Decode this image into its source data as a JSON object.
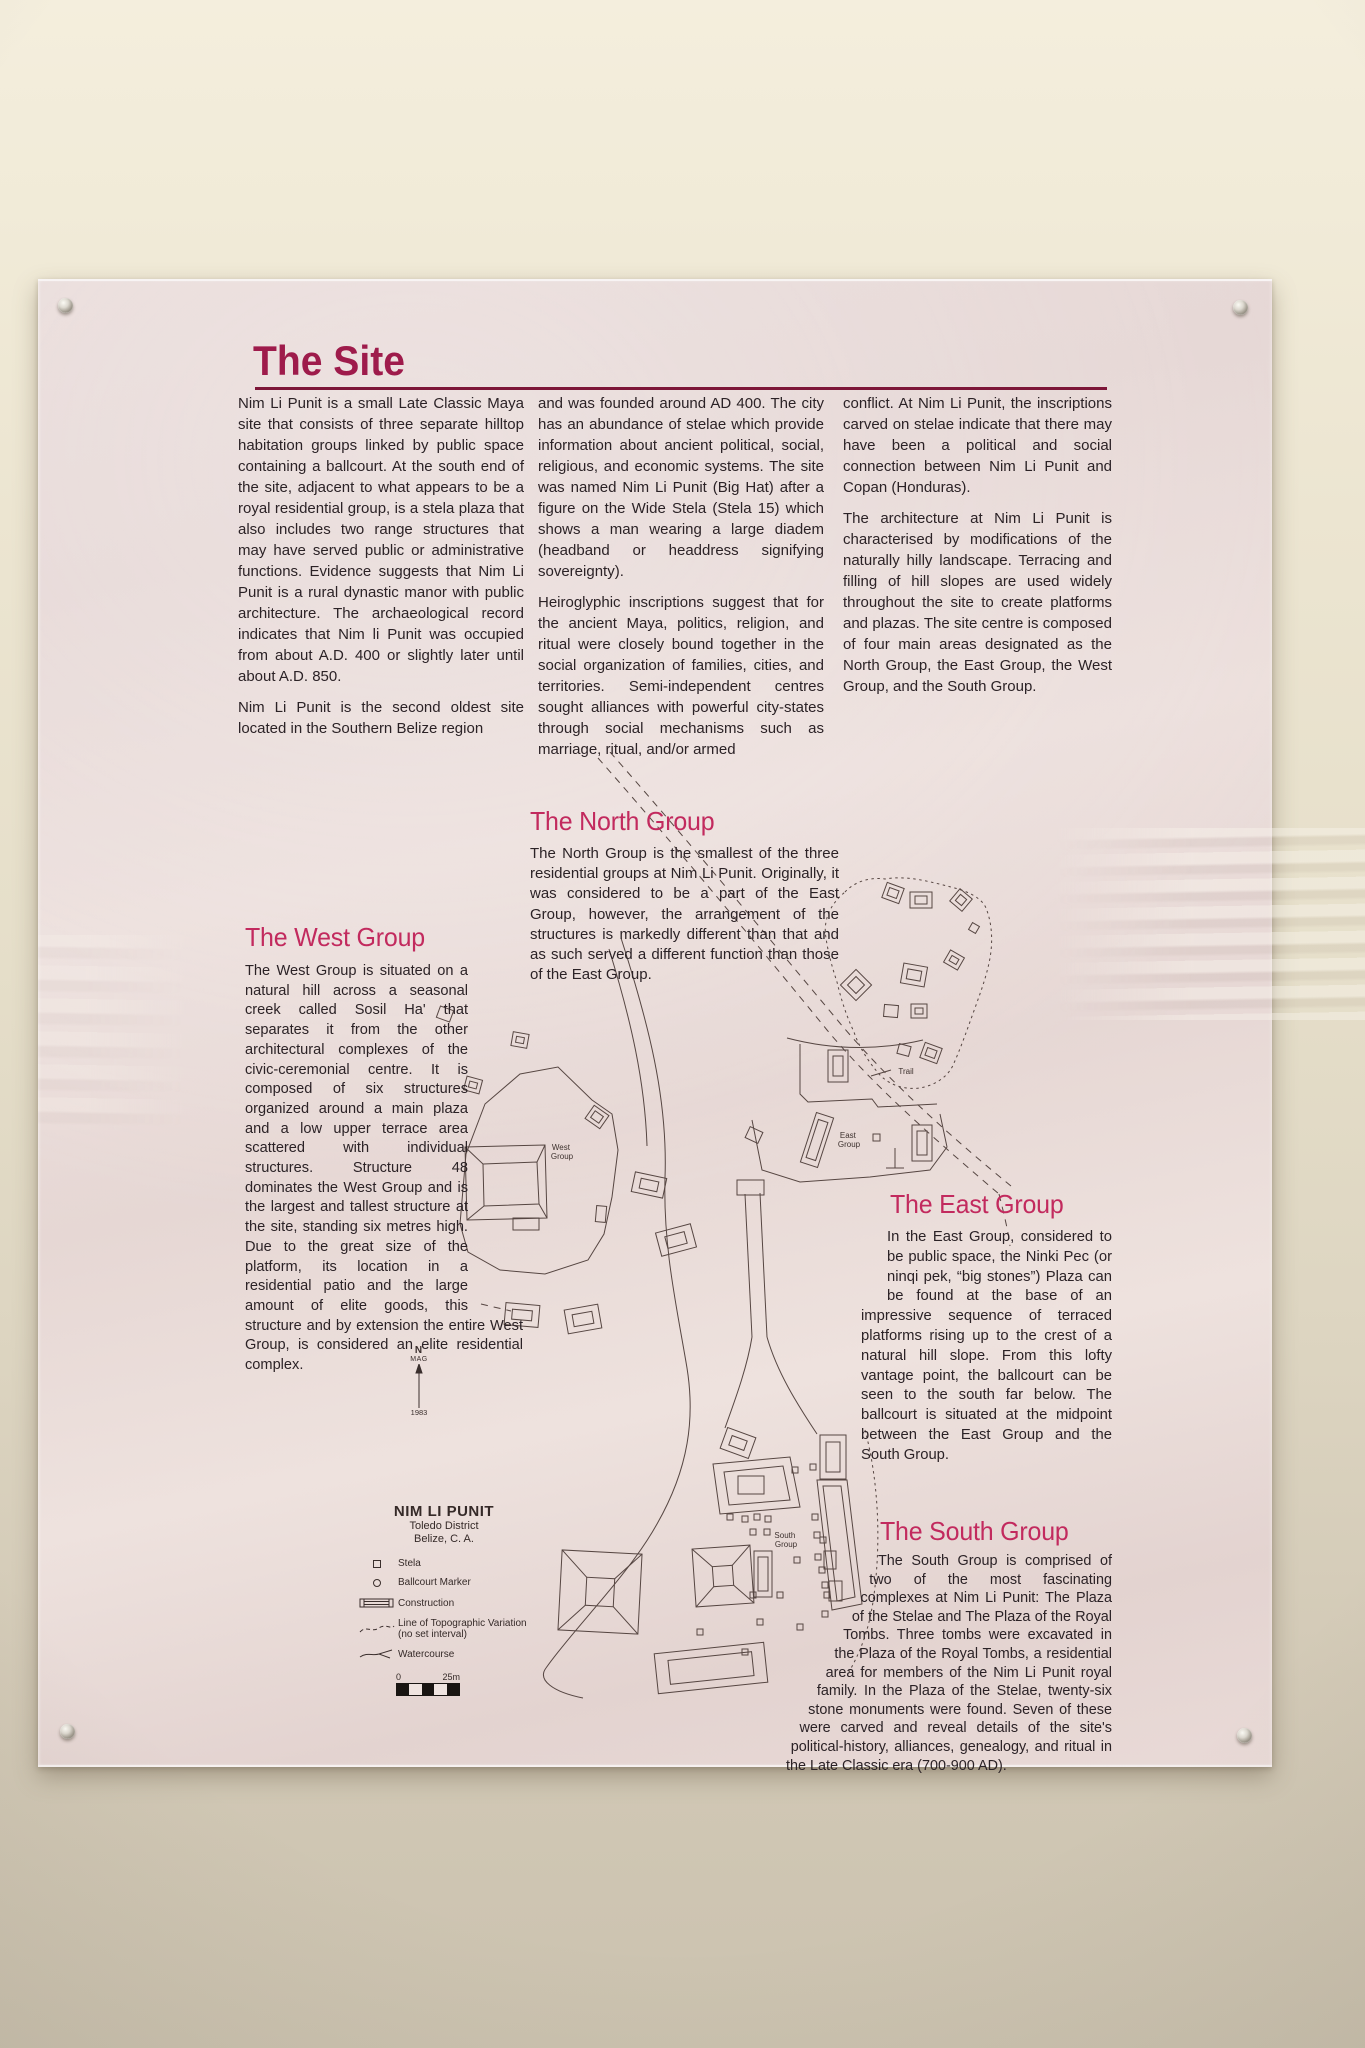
{
  "panel": {
    "title": "The Site",
    "intro": {
      "col1": {
        "p1": "Nim Li Punit is a small Late Classic Maya site that consists of three separate hilltop habitation groups linked by public space containing a ballcourt. At the south end of the site, adjacent to what appears to be a royal residential group, is a stela plaza that also includes two range structures that may have served public or administrative functions. Evidence suggests that Nim Li Punit is a rural dynastic manor with public architecture. The archaeological record indicates that Nim li Punit was occupied from about A.D. 400 or slightly later until about A.D. 850.",
        "p2": "Nim Li Punit is the second oldest site located in the Southern Belize region"
      },
      "col2": {
        "p1": "and was founded around AD 400. The city has an abundance of stelae which provide information about ancient political, social, religious, and economic systems. The site was named Nim Li Punit (Big Hat) after a figure on the Wide Stela (Stela 15) which shows a man wearing a large diadem (headband or headdress signifying sovereignty).",
        "p2": "Heiroglyphic inscriptions suggest that for the ancient Maya, politics, religion, and ritual were closely bound together in the social organization of families, cities, and territories. Semi-independent centres sought alliances with powerful city-states through social mechanisms such as marriage, ritual, and/or armed"
      },
      "col3": {
        "p1": "conflict. At Nim Li Punit, the inscriptions carved on stelae indicate that there may have been a political and social connection between Nim Li Punit and Copan (Honduras).",
        "p2": "The architecture at Nim Li Punit is characterised by modifications of the naturally hilly landscape. Terracing and filling of hill slopes are used widely throughout the site to create platforms and plazas. The site centre is composed of four main areas designated as the North Group, the East Group, the West Group, and the South Group."
      }
    },
    "sections": {
      "north": {
        "heading": "The North Group",
        "body": "The North Group is the smallest of the three residential groups at Nim Li Punit. Originally, it was considered to be a part of the East Group, however, the arrangement of the structures is markedly different than that and as such served a different function than those of the East Group."
      },
      "west": {
        "heading": "The West Group",
        "body": "The West Group is situated on a natural hill across a seasonal creek called Sosil Ha' that separates it from the other architectural complexes of the civic-ceremonial centre. It is composed of six structures organized around a main plaza and a low upper terrace area scattered with individual structures. Structure 48 dominates the West Group and is the largest and tallest structure at the site, standing six metres high. Due to the great size of the platform, its location in a residential patio and the large amount of elite goods, this structure and by extension the entire West Group, is considered an elite residential complex."
      },
      "east": {
        "heading": "The East Group",
        "body": "In the East Group, considered to be public space, the Ninki Pec (or ninqi pek, “big stones”) Plaza can be found at the base of an impressive sequence of terraced platforms rising up to the crest of a natural hill slope. From this lofty vantage point, the ballcourt can be seen to the south far below. The ballcourt is situated at the midpoint between the East Group and the South Group."
      },
      "south": {
        "heading": "The South Group",
        "body": "The South Group is comprised of two of the most fascinating complexes at Nim Li Punit: The Plaza of the Stelae and The Plaza of the Royal Tombs. Three tombs were excavated in the Plaza of the Royal Tombs, a residential area for members of the Nim Li Punit royal family. In the Plaza of the Stelae, twenty-six stone monuments were found. Seven of these were carved and reveal details of the site's political-history, alliances, genealogy, and ritual in the Late Classic era (700-900 AD)."
      }
    },
    "map": {
      "labels": {
        "west": {
          "line1": "West",
          "line2": "Group"
        },
        "east": {
          "line1": "East",
          "line2": "Group"
        },
        "south": {
          "line1": "South",
          "line2": "Group"
        },
        "trail": "Trail"
      },
      "compass": {
        "north": "N",
        "mag": "MAG",
        "year": "1983"
      },
      "legend": {
        "title": "NIM LI PUNIT",
        "district": "Toledo District",
        "country": "Belize, C. A.",
        "items": [
          {
            "label": "Stela"
          },
          {
            "label": "Ballcourt Marker"
          },
          {
            "label": "Construction"
          },
          {
            "label": "Line of Topographic Variation",
            "sublabel": "(no set interval)"
          },
          {
            "label": "Watercourse"
          }
        ],
        "scale": {
          "start": "0",
          "end": "25m"
        }
      }
    },
    "colors": {
      "title": "#9e1b4b",
      "underline": "#7d1638",
      "heading": "#c22a5e",
      "body_ink": "#2b2226",
      "map_ink": "#564642",
      "panel_tint": "#e7d8d5",
      "wall": "#e9e1cd"
    }
  }
}
